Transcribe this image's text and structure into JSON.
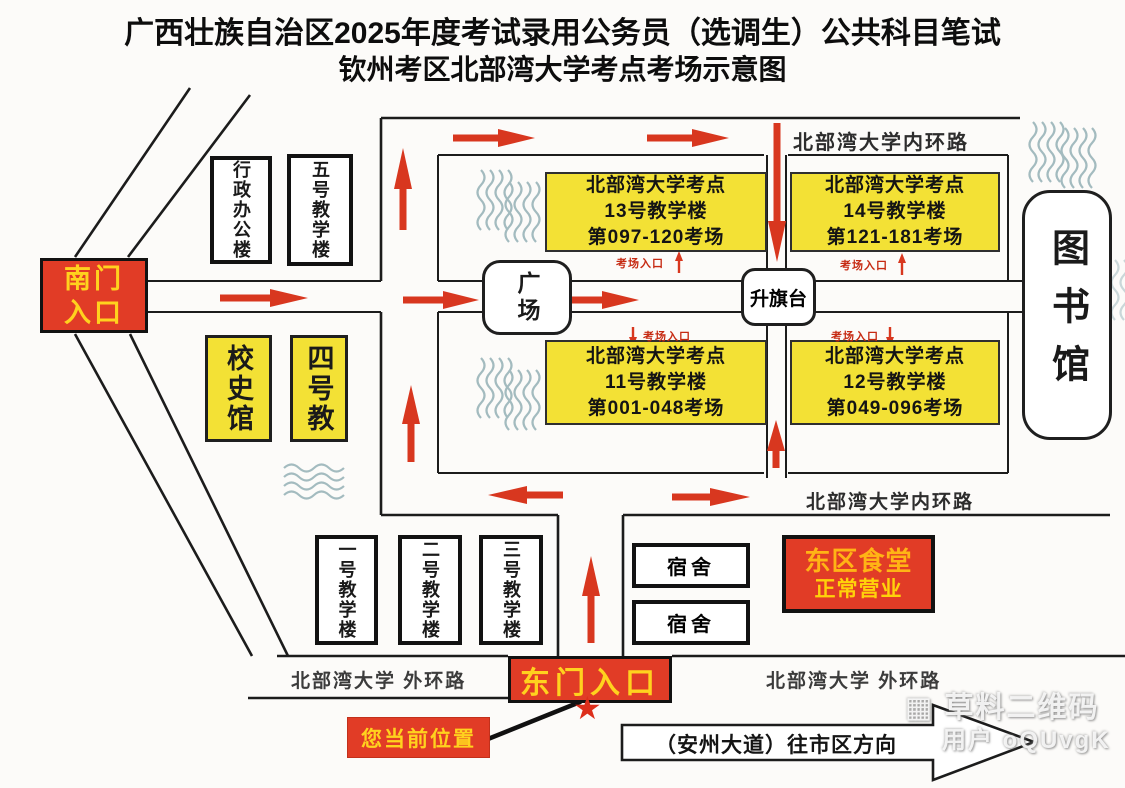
{
  "title": {
    "line1": "广西壮族自治区2025年度考试录用公务员（选调生）公共科目笔试",
    "line2": "钦州考区北部湾大学考点考场示意图"
  },
  "gates": {
    "south": "南门入口",
    "east": "东门入口"
  },
  "exam_buildings": [
    {
      "site": "北部湾大学考点",
      "building": "13号教学楼",
      "rooms": "第097-120考场"
    },
    {
      "site": "北部湾大学考点",
      "building": "14号教学楼",
      "rooms": "第121-181考场"
    },
    {
      "site": "北部湾大学考点",
      "building": "11号教学楼",
      "rooms": "第001-048考场"
    },
    {
      "site": "北部湾大学考点",
      "building": "12号教学楼",
      "rooms": "第049-096考场"
    }
  ],
  "buildings": {
    "admin": "行政办公楼",
    "teaching5": "五号教学楼",
    "history_hall": "校史馆",
    "teaching4": "四号教",
    "teaching1": "一号教学楼",
    "teaching2": "二号教学楼",
    "teaching3": "三号教学楼",
    "dorm": "宿舍",
    "plaza": "广场",
    "flag_stage": "升旗台",
    "library": "图书馆",
    "canteen_name": "东区食堂",
    "canteen_status": "正常营业"
  },
  "roads": {
    "inner_ring_top": "北部湾大学内环路",
    "inner_ring_bottom": "北部湾大学内环路",
    "outer_ring_left": "北部湾大学 外环路",
    "outer_ring_right": "北部湾大学 外环路",
    "avenue_direction": "（安州大道）往市区方向"
  },
  "markers": {
    "exam_entrance": "考场入口",
    "current_location": "您当前位置",
    "star_icon": "★"
  },
  "watermark": {
    "icon": "▦",
    "brand": "草料二维码",
    "user": "用户 oQUvgK"
  },
  "colors": {
    "highlight_yellow": "#f3e135",
    "gate_red": "#e13c26",
    "gate_text_yellow": "#ffd21e",
    "arrow_red": "#d8371f",
    "entrance_label_red": "#c62a12",
    "water_wave": "#a3bbbf"
  }
}
